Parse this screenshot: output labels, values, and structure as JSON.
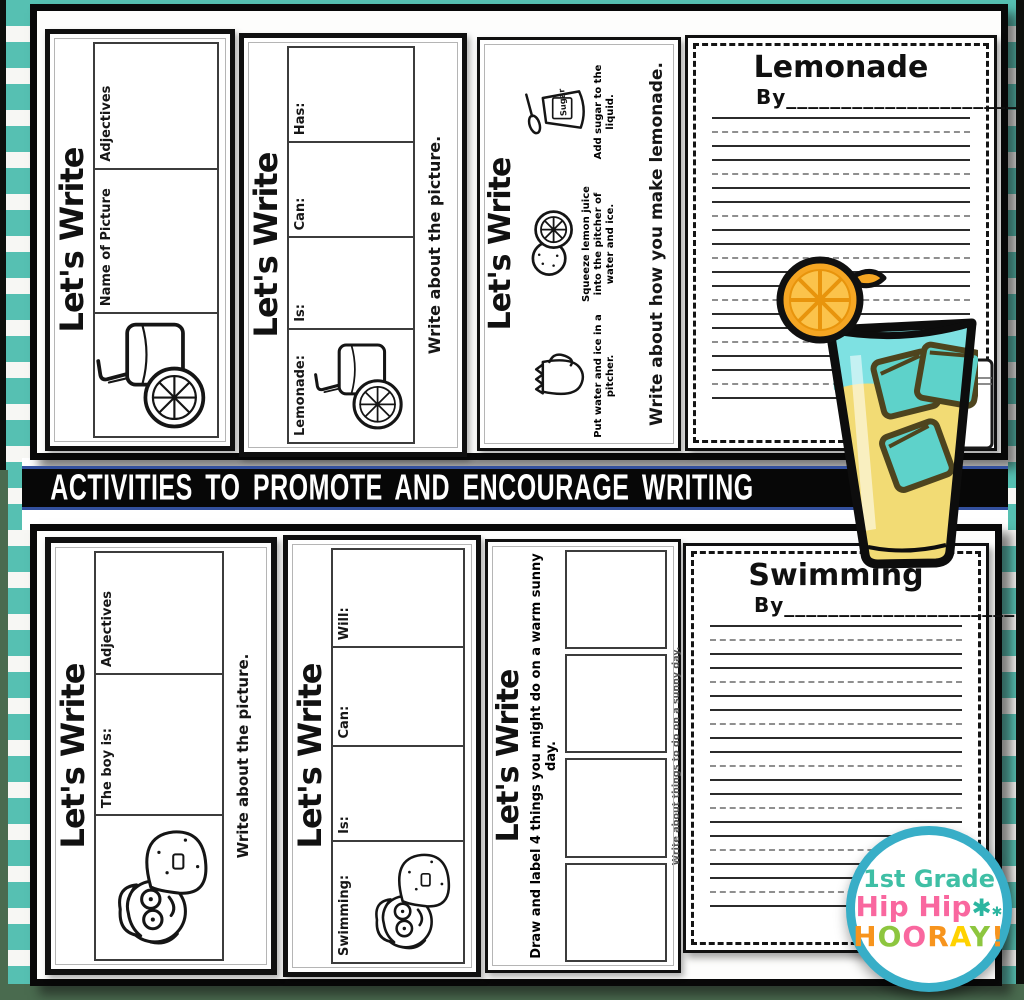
{
  "banner": {
    "text": "ACTIVITIES TO PROMOTE AND ENCOURAGE WRITING"
  },
  "cards": {
    "c1": {
      "title": "Let's Write",
      "box1_label": "Name of Picture",
      "box2_label": "Adjectives"
    },
    "c2": {
      "title": "Let's Write",
      "picture_label": "Lemonade:",
      "box1_label": "Is:",
      "box2_label": "Can:",
      "box3_label": "Has:",
      "caption": "Write about the picture."
    },
    "c3": {
      "title": "Let's Write",
      "step1_caption": "Put water and ice in a pitcher.",
      "step2_caption": "Squeeze lemon juice into the pitcher of water and ice.",
      "step3_caption": "Add sugar to the liquid.",
      "sugar_label": "Sugar",
      "caption": "Write about how you make lemonade."
    },
    "c4": {
      "title": "Let's Write",
      "box1_label": "The boy is:",
      "box2_label": "Adjectives",
      "caption": "Write about the picture."
    },
    "c5": {
      "title": "Let's Write",
      "picture_label": "Swimming:",
      "box1_label": "Is:",
      "box2_label": "Can:",
      "box3_label": "Will:"
    },
    "c6": {
      "title": "Let's Write",
      "prompt": "Draw and label 4 things you might do on a warm sunny day.",
      "caption": "Write about things to do on a sunny day."
    }
  },
  "papers": {
    "lemonade": {
      "title": "Lemonade",
      "byline": "By_____________________"
    },
    "swimming": {
      "title": "Swimming",
      "byline": "By_____________________"
    }
  },
  "logo": {
    "line1": "1st Grade",
    "line2": "Hip Hip",
    "asterisk": "✱",
    "hooray_letters": [
      "H",
      "O",
      "O",
      "R",
      "A",
      "Y",
      "!"
    ],
    "hooray_colors": [
      "#F7941D",
      "#8DC63F",
      "#F9679F",
      "#F7941D",
      "#FFD200",
      "#8DC63F",
      "#F7941D"
    ]
  },
  "colors": {
    "stripe_teal": "#56C0B2",
    "banner_border": "#33509E",
    "edge_green": "#4A6B4F",
    "lemonade_yellow": "#F2DB74",
    "drink_top_teal": "#7EE1E2",
    "ice_teal": "#5ED2CA",
    "lemon_orange": "#F5A623",
    "logo_ring": "#38AEC7"
  }
}
